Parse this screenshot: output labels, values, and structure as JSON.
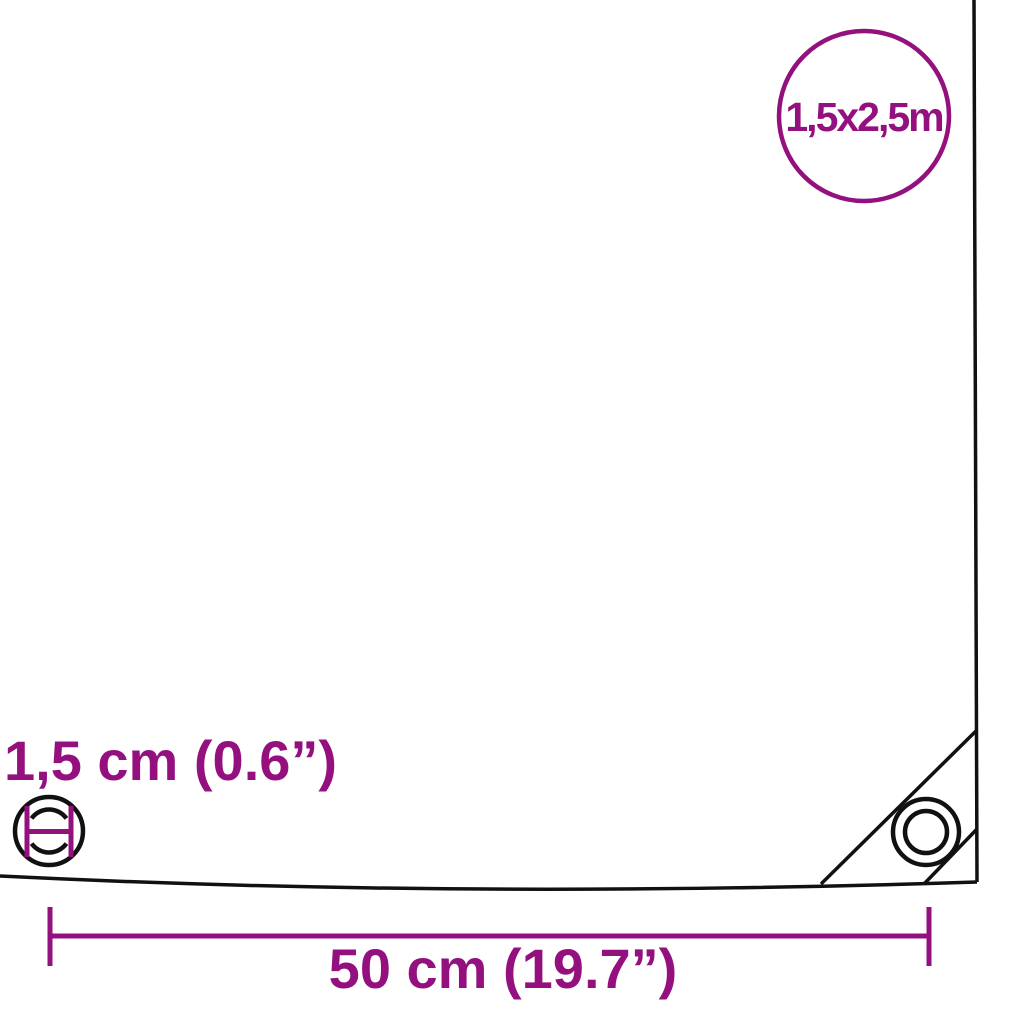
{
  "colors": {
    "accent": "#94107f",
    "line": "#111111",
    "background": "#ffffff"
  },
  "size_badge": {
    "label": "1,5x2,5m"
  },
  "eyelet_detail": {
    "label": "1,5 cm (0.6”)"
  },
  "edge_dimension": {
    "label": "50 cm (19.7”)"
  }
}
